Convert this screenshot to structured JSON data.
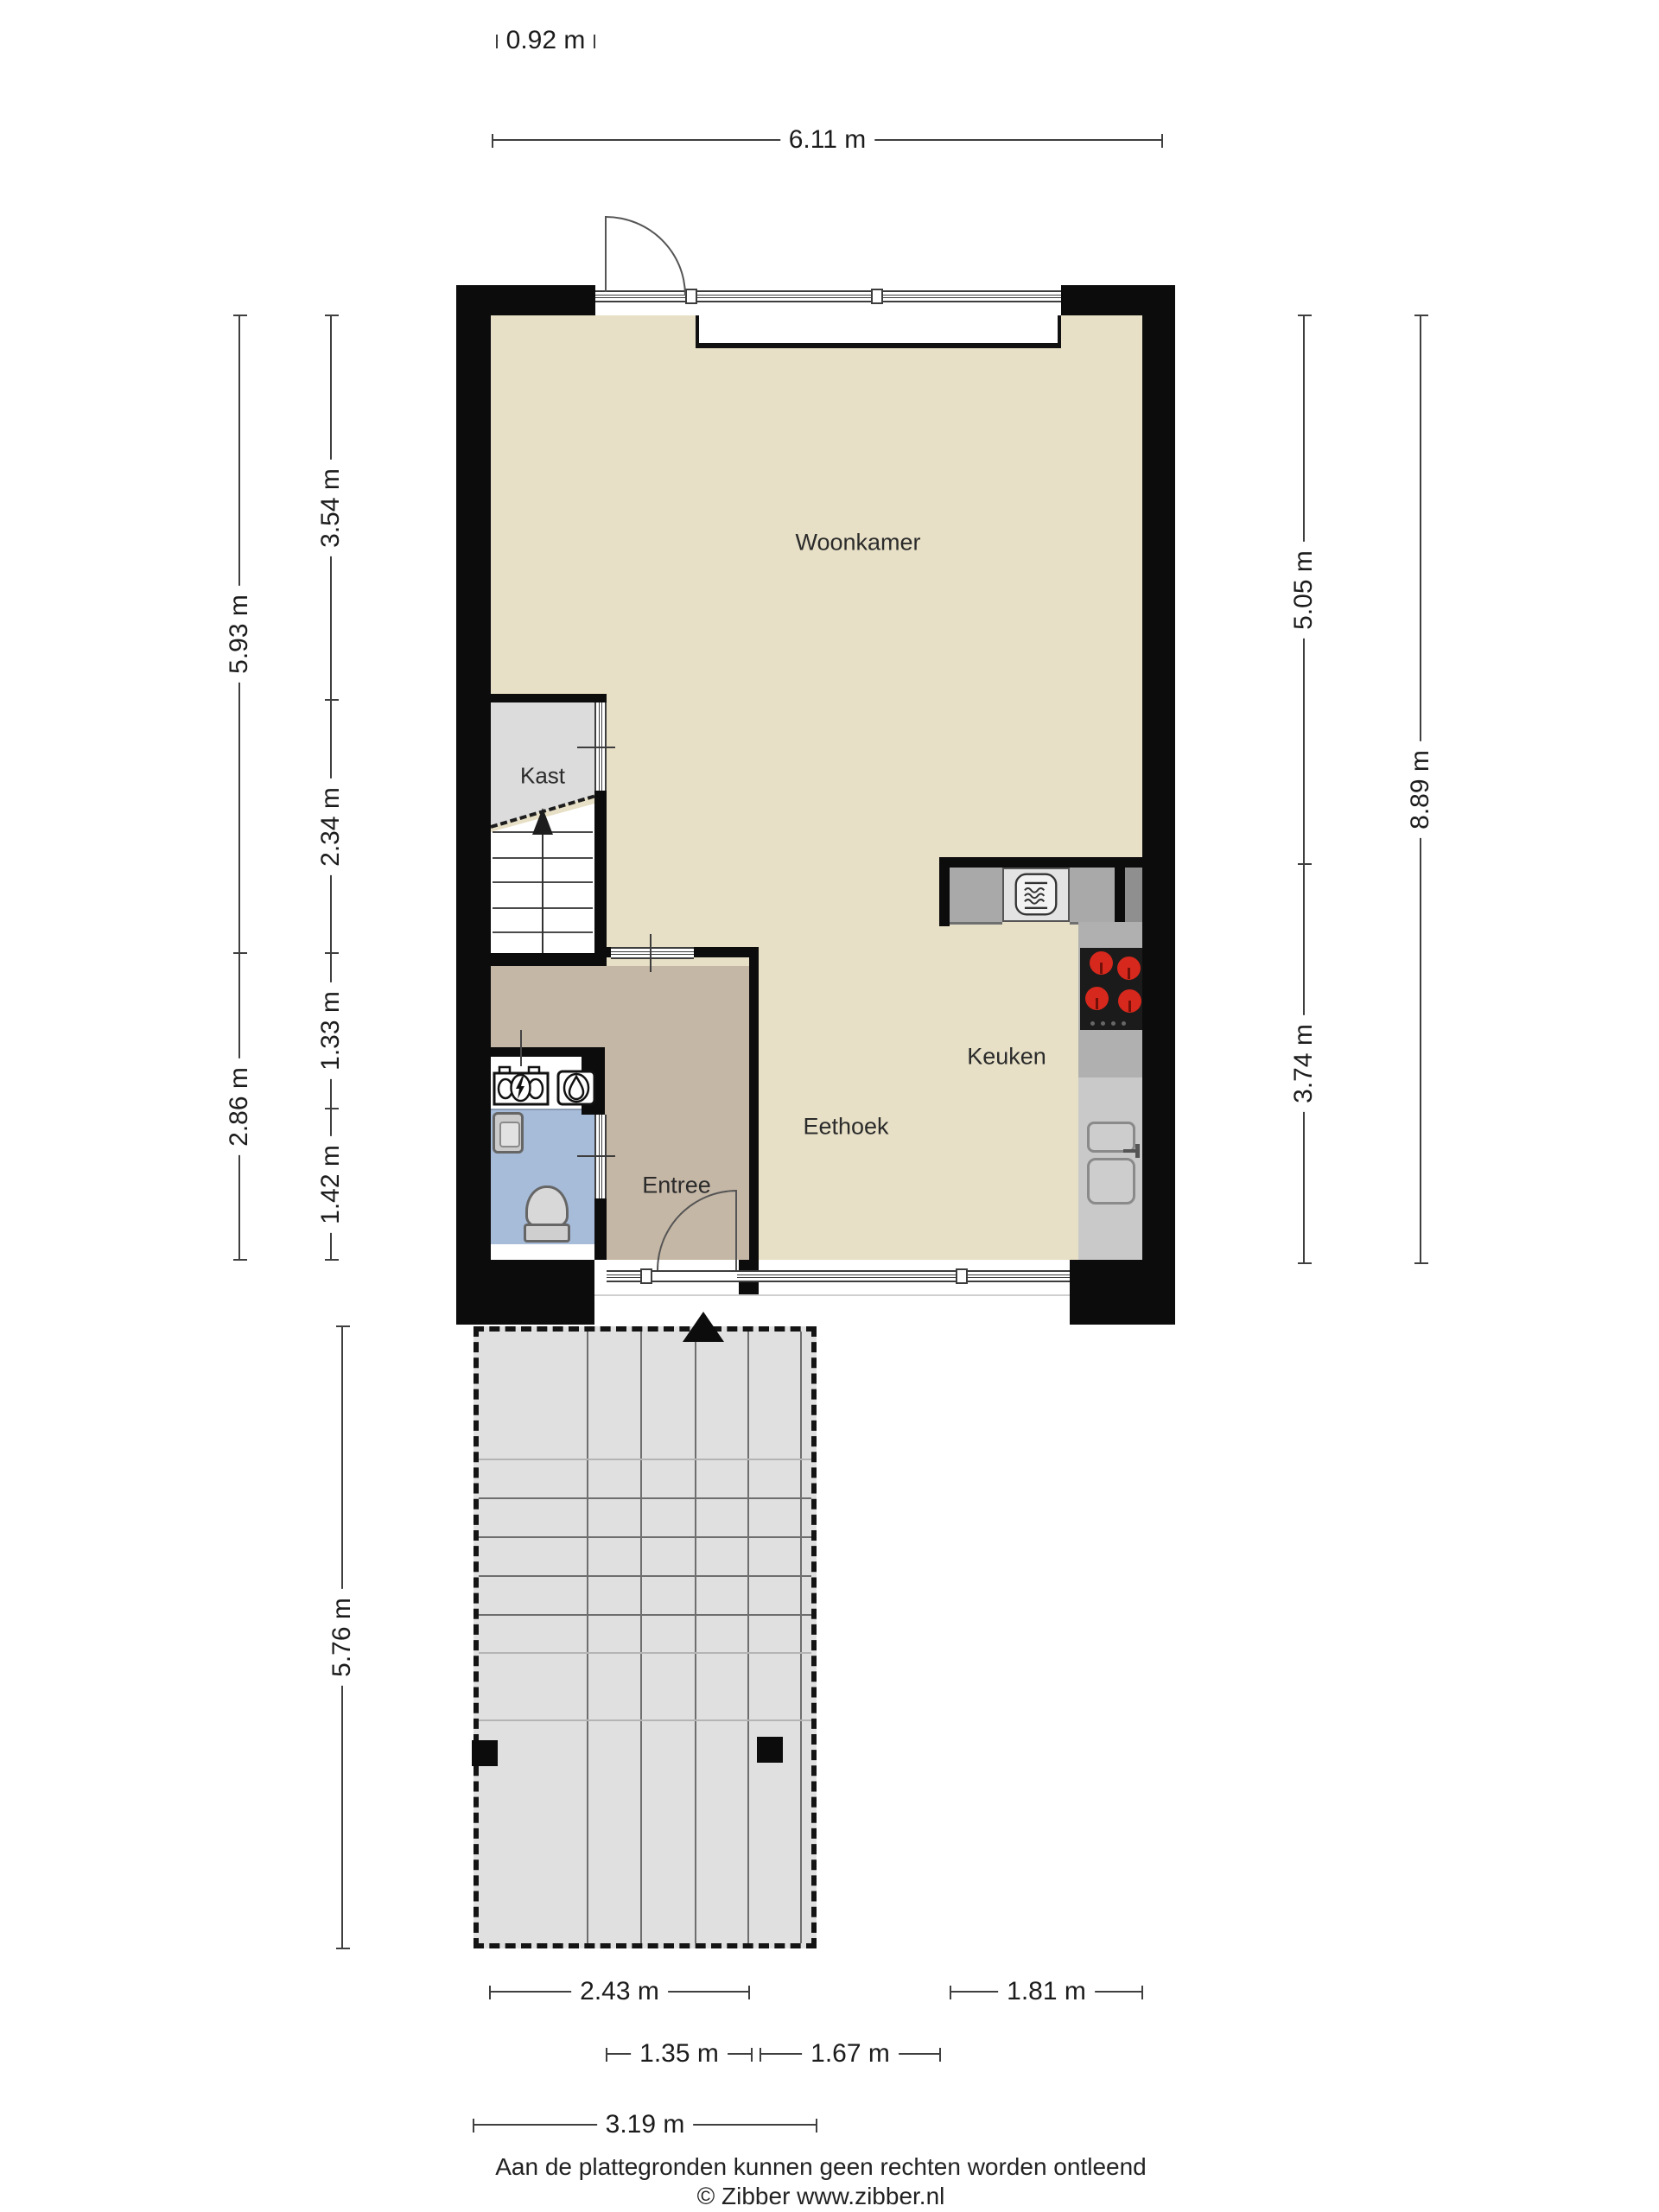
{
  "rooms": {
    "woonkamer": "Woonkamer",
    "kast": "Kast",
    "keuken": "Keuken",
    "eethoek": "Eethoek",
    "entree": "Entree",
    "carport": "Carport"
  },
  "dimensions": {
    "top_bay": "0.92 m",
    "top_width": "6.11 m",
    "left_outer": [
      "5.93 m",
      "2.86 m"
    ],
    "left_inner": [
      "3.54 m",
      "2.34 m",
      "1.33 m",
      "1.42 m"
    ],
    "carport_height": "5.76 m",
    "right_inner": [
      "5.05 m",
      "3.74 m"
    ],
    "right_outer": "8.89 m",
    "bottom_row1": [
      "2.43 m",
      "1.81 m"
    ],
    "bottom_row2": [
      "1.35 m",
      "1.67 m"
    ],
    "bottom_row3": "3.19 m"
  },
  "footer": {
    "disclaimer": "Aan de plattegronden kunnen geen rechten worden ontleend",
    "copyright": "© Zibber www.zibber.nl"
  },
  "colors": {
    "wall": "#0c0c0c",
    "floor": "#e7e0c6",
    "entree": "#c5b7a6",
    "toilet": "#a7bcd9",
    "kast": "#dcdcdc",
    "carport": "#e0e0e0",
    "burner": "#d6281c"
  }
}
